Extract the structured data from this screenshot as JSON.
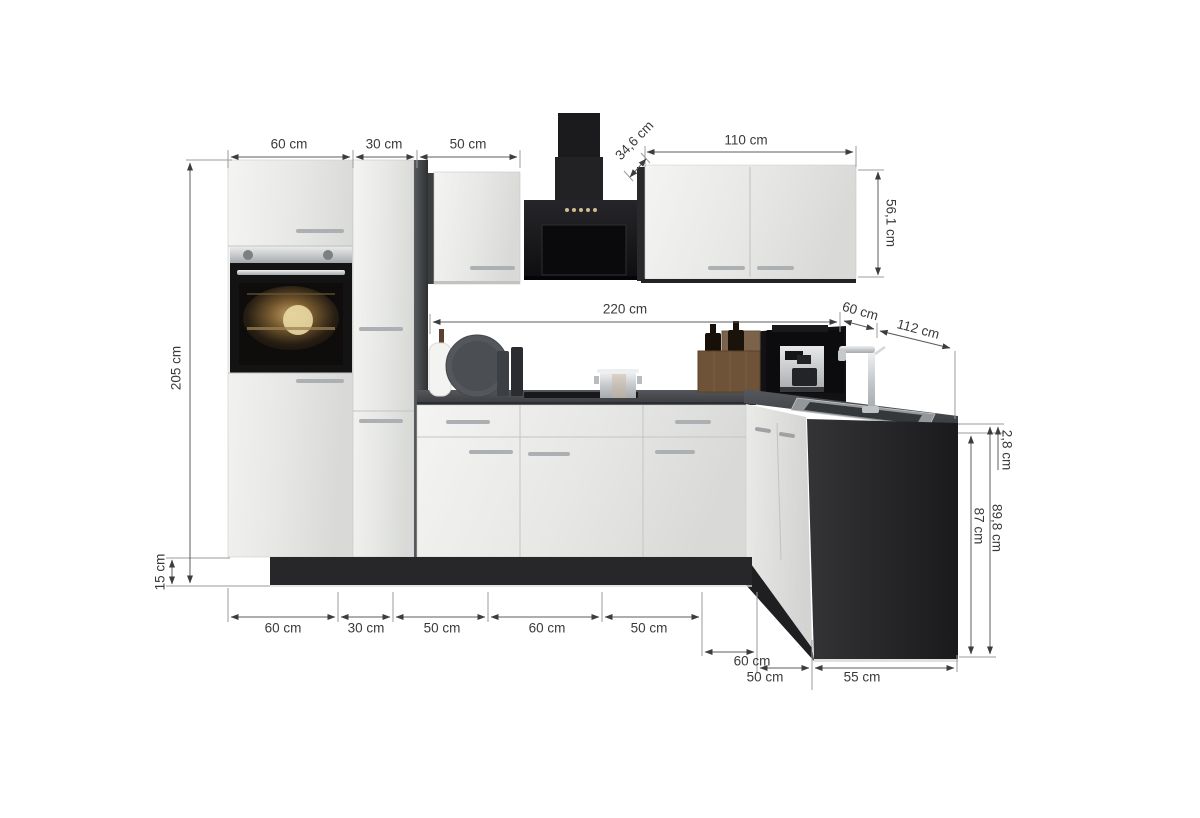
{
  "diagram": {
    "type": "kitchen-corner-unit-dimension-diagram",
    "dimensions": {
      "top_row": [
        {
          "label": "60 cm"
        },
        {
          "label": "30 cm"
        },
        {
          "label": "50 cm"
        }
      ],
      "hood_depth": {
        "label": "34,6 cm"
      },
      "wall_cabinet_width": {
        "label": "110 cm"
      },
      "wall_cabinet_height": {
        "label": "56,1 cm"
      },
      "total_height": {
        "label": "205 cm"
      },
      "plinth_height": {
        "label": "15 cm"
      },
      "run_length": {
        "label": "220 cm"
      },
      "corner_depth": {
        "label": "60 cm"
      },
      "return_length": {
        "label": "112 cm"
      },
      "worktop_thickness": {
        "label": "2,8 cm"
      },
      "carcass_height": {
        "label": "87 cm"
      },
      "working_height": {
        "label": "89,8 cm"
      },
      "bottom_row": [
        {
          "label": "60 cm"
        },
        {
          "label": "30 cm"
        },
        {
          "label": "50 cm"
        },
        {
          "label": "60 cm"
        },
        {
          "label": "50 cm"
        }
      ],
      "bottom_right_row": [
        {
          "label": "60 cm"
        },
        {
          "label": "50 cm"
        },
        {
          "label": "55 cm"
        }
      ]
    },
    "colors": {
      "cabinet_front": "#ededeb",
      "carcass_dark": "#2e3032",
      "worktop": "#43464a",
      "plinth": "#27272a",
      "appliance_black": "#121214",
      "steel": "#c9cccd",
      "dimension_line": "#5c5c5c",
      "extension_line": "#9b9b9b",
      "dimension_text": "#3a3a3a",
      "background": "#ffffff"
    }
  }
}
